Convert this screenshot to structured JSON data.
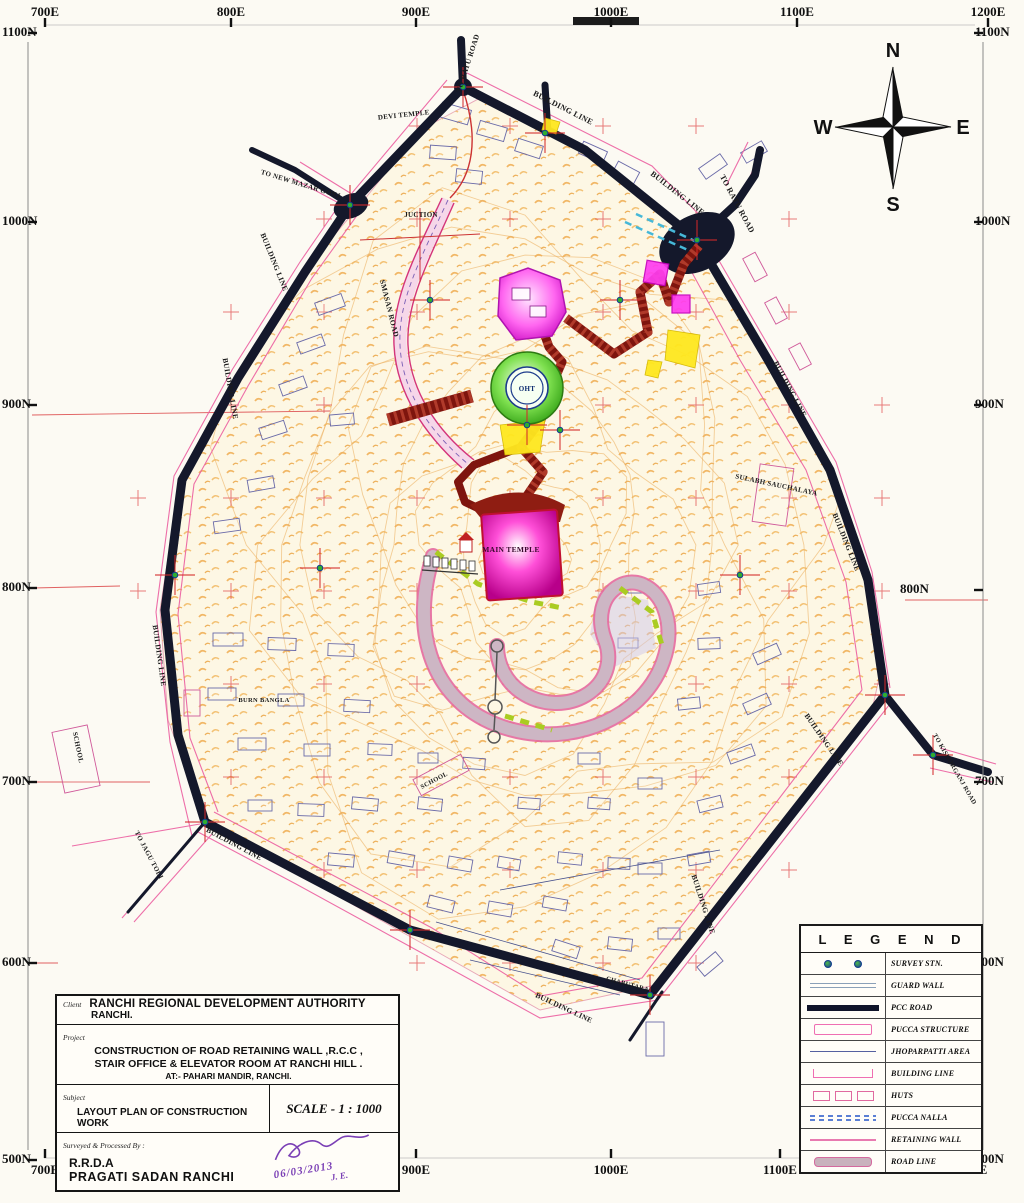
{
  "sheet": {
    "bg": "#fcfaf3",
    "paper": "scanned layout plan"
  },
  "compass": {
    "n": "N",
    "e": "E",
    "s": "S",
    "w": "W"
  },
  "grid": {
    "top": [
      {
        "text": "700E",
        "x": 45
      },
      {
        "text": "800E",
        "x": 231
      },
      {
        "text": "900E",
        "x": 416
      },
      {
        "text": "1000E",
        "x": 611
      },
      {
        "text": "1100E",
        "x": 797
      },
      {
        "text": "1200E",
        "x": 988
      }
    ],
    "bottom": [
      {
        "text": "700E",
        "x": 45
      },
      {
        "text": "800E",
        "x": 231
      },
      {
        "text": "900E",
        "x": 416
      },
      {
        "text": "1000E",
        "x": 611
      },
      {
        "text": "1100E",
        "x": 780
      },
      {
        "text": "1200E",
        "x": 970
      }
    ],
    "left": [
      {
        "text": "1100N",
        "y": 33
      },
      {
        "text": "1000N",
        "y": 222
      },
      {
        "text": "900N",
        "y": 405
      },
      {
        "text": "800N",
        "y": 588
      },
      {
        "text": "700N",
        "y": 782
      },
      {
        "text": "600N",
        "y": 963
      },
      {
        "text": "500N",
        "y": 1160
      }
    ],
    "right": [
      {
        "text": "1100N",
        "y": 33
      },
      {
        "text": "1000N",
        "y": 222
      },
      {
        "text": "900N",
        "y": 405
      },
      {
        "text": "800N",
        "y": 590,
        "inset": true
      },
      {
        "text": "700N",
        "y": 782
      },
      {
        "text": "600N",
        "y": 963
      },
      {
        "text": "500N",
        "y": 1160
      }
    ]
  },
  "legend": {
    "title": "L E G E N D",
    "items": [
      {
        "key": "survey-stn",
        "label": "SURVEY STN."
      },
      {
        "key": "guard-wall",
        "label": "GUARD WALL"
      },
      {
        "key": "pcc-road",
        "label": "PCC ROAD"
      },
      {
        "key": "pucca-structure",
        "label": "PUCCA STRUCTURE"
      },
      {
        "key": "jhoparpatti-area",
        "label": "JHOPARPATTI AREA"
      },
      {
        "key": "building-line",
        "label": "BUILDING LINE"
      },
      {
        "key": "huts",
        "label": "HUTS"
      },
      {
        "key": "pucca-nalla",
        "label": "PUCCA NALLA"
      },
      {
        "key": "retaining-wall",
        "label": "RETAINING WALL"
      },
      {
        "key": "road-line",
        "label": "ROAD LINE"
      }
    ]
  },
  "title_block": {
    "client_label": "Client",
    "client": "RANCHI REGIONAL DEVELOPMENT AUTHORITY",
    "client_sub": "RANCHI.",
    "project_label": "Project",
    "project_l1": "CONSTRUCTION OF ROAD RETAINING WALL ,R.C.C ,",
    "project_l2": "STAIR OFFICE & ELEVATOR ROOM AT RANCHI HILL .",
    "project_l3": "AT:- PAHARI MANDIR, RANCHI.",
    "subject_label": "Subject",
    "subject": "LAYOUT PLAN OF CONSTRUCTION WORK",
    "scale": "SCALE - 1 : 1000",
    "surveyed_label": "Surveyed & Processed By :",
    "surveyed_l1": "R.R.D.A",
    "surveyed_l2": "PRAGATI SADAN   RANCHI",
    "sign_date": "06/03/2013",
    "sign_je": "J. E."
  },
  "map": {
    "labels": [
      {
        "t": "TO RATU ROAD",
        "x": 470,
        "y": 64,
        "r": -72,
        "s": 7.5
      },
      {
        "t": "BUILDING LINE",
        "x": 562,
        "y": 110,
        "r": 27,
        "s": 8
      },
      {
        "t": "DEVI TEMPLE",
        "x": 404,
        "y": 117,
        "r": -6,
        "s": 7
      },
      {
        "t": "TO NEW MAZAR GONJ",
        "x": 300,
        "y": 186,
        "r": 17,
        "s": 7
      },
      {
        "t": "BUILDING LINE",
        "x": 272,
        "y": 263,
        "r": 68,
        "s": 7.5
      },
      {
        "t": "JUCTION",
        "x": 421,
        "y": 217,
        "r": 0,
        "s": 7
      },
      {
        "t": "BUILDING LINE",
        "x": 676,
        "y": 195,
        "r": 38,
        "s": 8
      },
      {
        "t": "TO RATU ROAD",
        "x": 735,
        "y": 205,
        "r": 62,
        "s": 8
      },
      {
        "t": "SMASAN ROAD",
        "x": 387,
        "y": 309,
        "r": 76,
        "s": 7.5
      },
      {
        "t": "BUILDING LINE",
        "x": 228,
        "y": 389,
        "r": 80,
        "s": 7.5
      },
      {
        "t": "BUILDING LINE",
        "x": 788,
        "y": 390,
        "r": 62,
        "s": 7.5
      },
      {
        "t": "SULABH SAUCHALAYA",
        "x": 776,
        "y": 487,
        "r": 12,
        "s": 7
      },
      {
        "t": "BUILDING LINE",
        "x": 844,
        "y": 543,
        "r": 68,
        "s": 7.5
      },
      {
        "t": "BUILDING LINE",
        "x": 157,
        "y": 656,
        "r": 82,
        "s": 7.5
      },
      {
        "t": "BURN BANGLA",
        "x": 264,
        "y": 702,
        "r": 0,
        "s": 6.5
      },
      {
        "t": "SCHOOL",
        "x": 76,
        "y": 748,
        "r": 78,
        "s": 7
      },
      {
        "t": "SCHOOL",
        "x": 435,
        "y": 782,
        "r": -28,
        "s": 6.5
      },
      {
        "t": "BUILDING LINE",
        "x": 233,
        "y": 846,
        "r": 28,
        "s": 7.5
      },
      {
        "t": "TO JAGU TOLI",
        "x": 147,
        "y": 856,
        "r": 62,
        "s": 7
      },
      {
        "t": "BUILDING LINE",
        "x": 822,
        "y": 741,
        "r": 55,
        "s": 7.5
      },
      {
        "t": "TO KISHORGANJ ROAD",
        "x": 953,
        "y": 770,
        "r": 60,
        "s": 6.5
      },
      {
        "t": "BUILDING LINE",
        "x": 701,
        "y": 905,
        "r": 72,
        "s": 7.5
      },
      {
        "t": "BUILDING LINE",
        "x": 563,
        "y": 1010,
        "r": 25,
        "s": 7.5
      },
      {
        "t": "CHABUTARA",
        "x": 627,
        "y": 986,
        "r": 15,
        "s": 6.5
      },
      {
        "t": "MAIN TEMPLE",
        "x": 511,
        "y": 552,
        "r": 0,
        "s": 7.5,
        "c": "#38092c",
        "b": 1
      },
      {
        "t": "OHT",
        "x": 527,
        "y": 391,
        "r": 0,
        "s": 7,
        "c": "#0a2a6e",
        "b": 1
      }
    ],
    "huts": [
      [
        440,
        106,
        30,
        15,
        16
      ],
      [
        478,
        124,
        28,
        14,
        16
      ],
      [
        516,
        142,
        26,
        13,
        18
      ],
      [
        580,
        146,
        26,
        13,
        24
      ],
      [
        614,
        166,
        24,
        13,
        28
      ],
      [
        430,
        146,
        26,
        13,
        4
      ],
      [
        456,
        170,
        26,
        13,
        6
      ],
      [
        742,
        260,
        26,
        14,
        62,
        1
      ],
      [
        764,
        304,
        24,
        13,
        62,
        1
      ],
      [
        788,
        350,
        24,
        13,
        62,
        1
      ],
      [
        756,
        466,
        34,
        58,
        8,
        1
      ],
      [
        316,
        298,
        28,
        13,
        -20
      ],
      [
        298,
        338,
        26,
        12,
        -20
      ],
      [
        280,
        380,
        26,
        12,
        -20
      ],
      [
        260,
        424,
        26,
        12,
        -18
      ],
      [
        330,
        414,
        24,
        11,
        -5
      ],
      [
        248,
        478,
        26,
        12,
        -10
      ],
      [
        214,
        520,
        26,
        12,
        -8
      ],
      [
        213,
        633,
        30,
        13,
        0
      ],
      [
        268,
        638,
        28,
        12,
        2
      ],
      [
        328,
        644,
        26,
        12,
        2
      ],
      [
        208,
        688,
        28,
        12,
        0
      ],
      [
        278,
        694,
        26,
        12,
        0
      ],
      [
        344,
        700,
        26,
        12,
        3
      ],
      [
        238,
        738,
        28,
        12,
        0
      ],
      [
        304,
        744,
        26,
        12,
        0
      ],
      [
        368,
        744,
        24,
        11,
        2
      ],
      [
        352,
        798,
        26,
        12,
        5
      ],
      [
        418,
        798,
        24,
        12,
        6
      ],
      [
        298,
        804,
        26,
        12,
        2
      ],
      [
        248,
        800,
        24,
        11,
        0
      ],
      [
        388,
        853,
        26,
        12,
        10
      ],
      [
        328,
        854,
        26,
        12,
        5
      ],
      [
        448,
        858,
        24,
        12,
        10
      ],
      [
        428,
        898,
        26,
        12,
        14
      ],
      [
        488,
        903,
        24,
        12,
        10
      ],
      [
        543,
        898,
        24,
        11,
        10
      ],
      [
        498,
        858,
        22,
        11,
        10
      ],
      [
        558,
        853,
        24,
        11,
        6
      ],
      [
        608,
        858,
        22,
        11,
        2
      ],
      [
        553,
        943,
        26,
        12,
        18
      ],
      [
        608,
        938,
        24,
        12,
        6
      ],
      [
        658,
        928,
        22,
        11,
        0
      ],
      [
        638,
        863,
        24,
        11,
        0
      ],
      [
        688,
        853,
        22,
        11,
        -10
      ],
      [
        698,
        798,
        24,
        12,
        -14
      ],
      [
        728,
        748,
        26,
        12,
        -20
      ],
      [
        744,
        698,
        26,
        12,
        -24
      ],
      [
        754,
        648,
        26,
        12,
        -24
      ],
      [
        698,
        638,
        22,
        11,
        -2
      ],
      [
        678,
        698,
        22,
        11,
        -6
      ],
      [
        638,
        778,
        24,
        11,
        0
      ],
      [
        588,
        798,
        22,
        11,
        4
      ],
      [
        628,
        583,
        20,
        10,
        0
      ],
      [
        698,
        583,
        22,
        11,
        -8
      ],
      [
        618,
        638,
        20,
        10,
        0
      ],
      [
        578,
        753,
        22,
        11,
        0
      ],
      [
        518,
        798,
        22,
        11,
        4
      ],
      [
        463,
        758,
        22,
        11,
        4
      ],
      [
        418,
        753,
        20,
        10,
        0
      ],
      [
        646,
        1022,
        18,
        34,
        0
      ],
      [
        698,
        958,
        24,
        12,
        -40
      ],
      [
        58,
        728,
        36,
        62,
        -12,
        1
      ],
      [
        184,
        690,
        16,
        26,
        0,
        1
      ],
      [
        414,
        766,
        54,
        18,
        -28,
        1
      ],
      [
        700,
        160,
        26,
        13,
        -35
      ],
      [
        742,
        146,
        24,
        12,
        -30
      ]
    ]
  }
}
